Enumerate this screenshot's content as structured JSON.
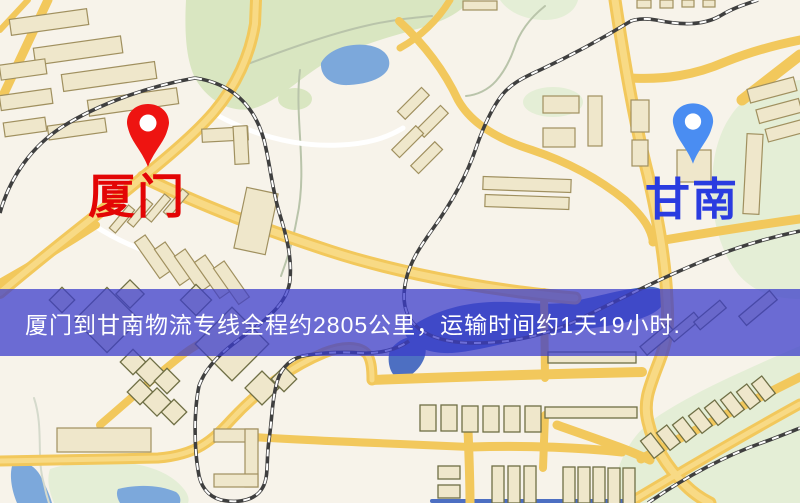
{
  "banner": {
    "text": "厦门到甘南物流专线全程约2805公里，运输时间约1天19小时.",
    "background_color": "rgba(58,60,202,0.74)",
    "text_color": "#ffffff"
  },
  "markers": {
    "origin": {
      "label": "厦门",
      "pin_color": "#ee1411",
      "label_color": "#e30505"
    },
    "destination": {
      "label": "甘南",
      "pin_color": "#4a8df2",
      "label_color": "#2a3ce0"
    }
  },
  "map_colors": {
    "background": "#f7f3ea",
    "road": "#f2c85c",
    "road_core": "#f8da85",
    "road_white": "#ffffff",
    "park": "#d9e6c1",
    "park_light": "#e4eed6",
    "water": "#7ca8db",
    "river": "#4d6fc2",
    "building_fill": "#efe7cb",
    "building_stroke": "#a0905f",
    "building_stroke_dark": "#6f6f45",
    "railway": "#3f3f3f",
    "stream": "#b9c4aa"
  }
}
